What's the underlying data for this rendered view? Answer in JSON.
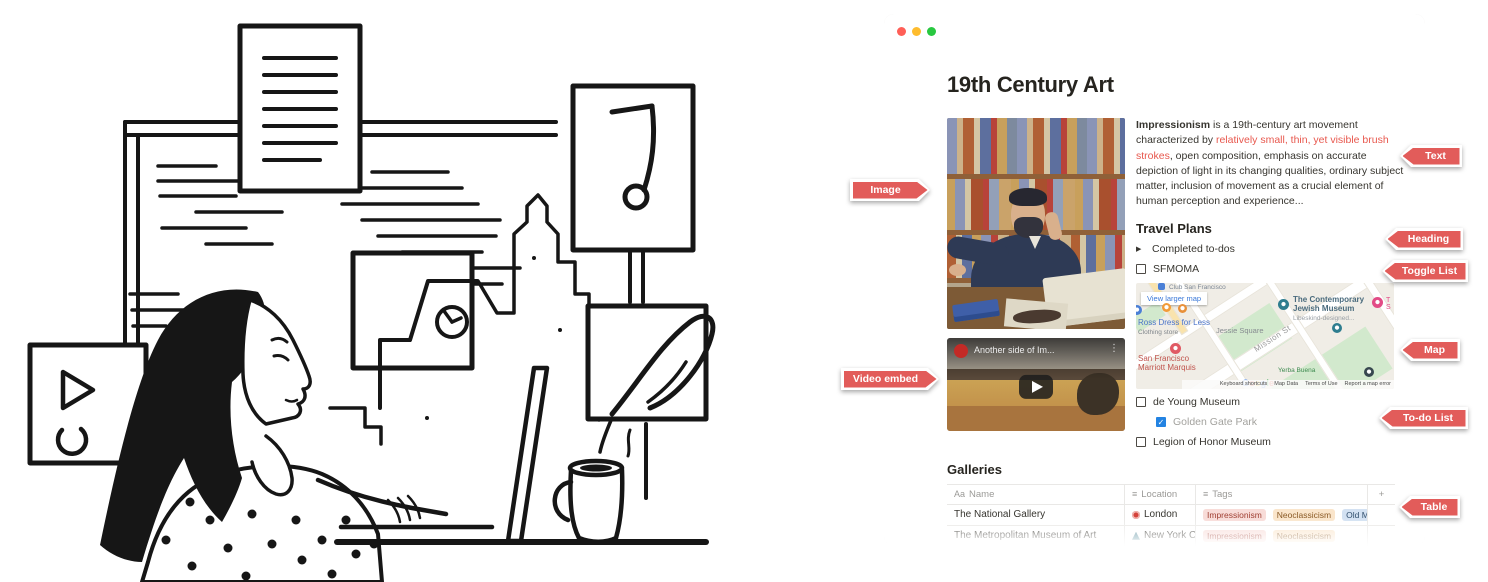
{
  "annotations": {
    "image": "Image",
    "video": "Video embed",
    "text": "Text",
    "heading": "Heading",
    "toggle_list": "Toggle List",
    "map": "Map",
    "todo_list": "To-do List",
    "table": "Table"
  },
  "window": {
    "title": "19th Century Art",
    "paragraph": {
      "lead": "Impressionism",
      "mid": " is a 19th-century art movement characterized by ",
      "highlight": "relatively small, thin, yet visible brush strokes",
      "rest": ", open composition, emphasis on accurate depiction of light in its changing qualities, ordinary subject matter, inclusion of movement as a crucial element of human perception and experience..."
    },
    "travel_heading": "Travel Plans",
    "toggle_label": "Completed to-dos",
    "todos": [
      {
        "label": "SFMOMA",
        "checked": false
      },
      {
        "label": "de Young Museum",
        "checked": false
      },
      {
        "label": "Golden Gate Park",
        "checked": true
      },
      {
        "label": "Legion of Honor Museum",
        "checked": false
      }
    ],
    "video": {
      "title": "Another side of Im..."
    },
    "map": {
      "view_larger": "View larger map",
      "club": "Club San Francisco",
      "museum": "The Contemporary Jewish Museum",
      "museum_sub": "Libeskind-designed...",
      "ross": "Ross Dress for Less",
      "ross_sub": "Clothing store",
      "square": "Jessie Square",
      "street": "Mission St",
      "hotel": "San Francisco Marriott Marquis",
      "park": "Yerba Buena",
      "partial_right": "T S",
      "google": [
        "G",
        "o",
        "o",
        "g",
        "l",
        "e"
      ],
      "attribution": [
        "Keyboard shortcuts",
        "Map Data",
        "Terms of Use",
        "Report a map error"
      ]
    },
    "galleries_heading": "Galleries",
    "table": {
      "columns": [
        {
          "icon_glyph": "Aa",
          "label": "Name"
        },
        {
          "icon_glyph": "≡",
          "label": "Location"
        },
        {
          "icon_glyph": "≡",
          "label": "Tags"
        }
      ],
      "add_label": "+",
      "rows": [
        {
          "name": "The National Gallery",
          "location": "London",
          "location_icon": "ferris-wheel-icon",
          "tags": [
            {
              "label": "Impressionism",
              "color": "red"
            },
            {
              "label": "Neoclassicism",
              "color": "orange"
            },
            {
              "label": "Old Masters",
              "color": "blue"
            }
          ]
        },
        {
          "name": "The Metropolitan Museum of Art",
          "location": "New York City",
          "location_icon": "statue-of-liberty-icon",
          "tags": [
            {
              "label": "Impressionism",
              "color": "red"
            },
            {
              "label": "Neoclassicism",
              "color": "orange"
            }
          ]
        }
      ]
    }
  },
  "icons": {
    "toggle_triangle": "▶",
    "kebab": "⋮",
    "check": "✓"
  },
  "colors": {
    "annotation_red": "#e25c5a",
    "notion_text": "#37352f",
    "highlight_red": "#e8584e",
    "checkbox_blue": "#2383e2",
    "tag_red_bg": "#f8dcd8",
    "tag_red_text": "#a04034",
    "tag_orange_bg": "#fae5cb",
    "tag_orange_text": "#8a5a26",
    "tag_blue_bg": "#d3e1f2",
    "tag_blue_text": "#33506e",
    "traffic_red": "#ff5f57",
    "traffic_yellow": "#febc2e",
    "traffic_green": "#28c840"
  }
}
